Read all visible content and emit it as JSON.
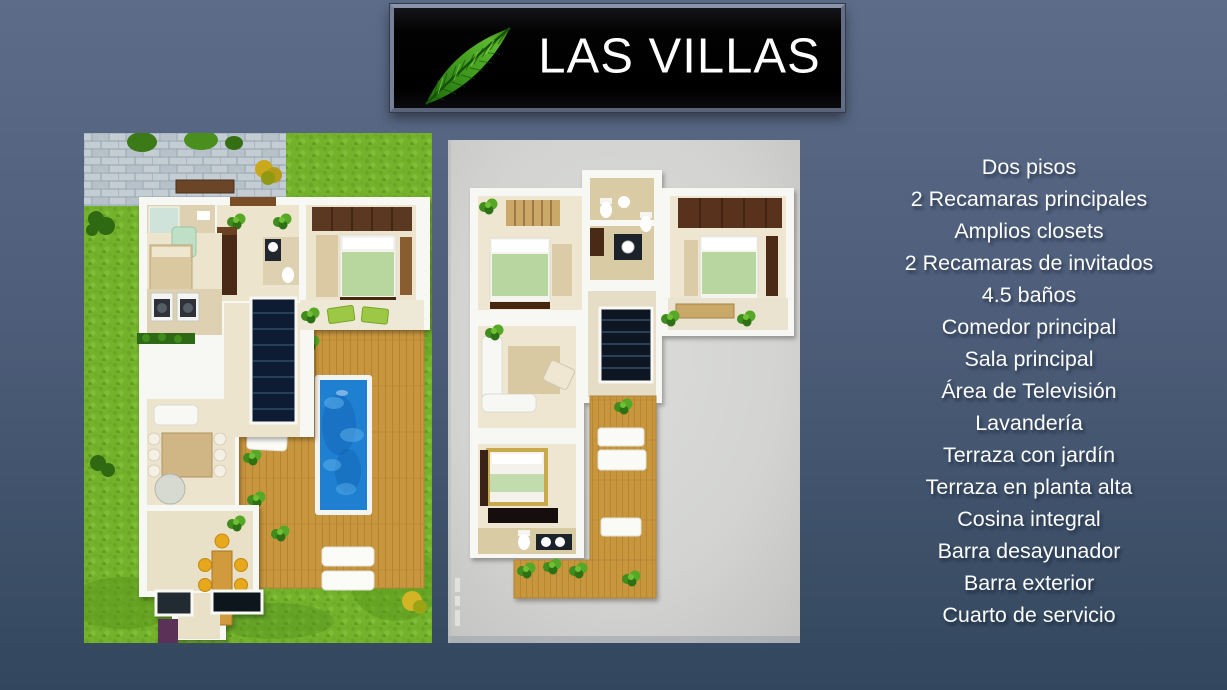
{
  "slide": {
    "title_banner": {
      "title": "LAS VILLAS",
      "icon": "palm-leaf"
    },
    "figures": {
      "left": "ground-floor-plan-render",
      "right": "upper-floor-plan-render"
    },
    "features": {
      "items": [
        "Dos pisos",
        "2 Recamaras principales",
        "Amplios closets",
        "2 Recamaras de invitados",
        "4.5 baños",
        "Comedor principal",
        "Sala principal",
        "Área de Televisión",
        "Lavandería",
        "Terraza con jardín",
        "Terraza en planta alta",
        "Cosina integral",
        "Barra desayunador",
        "Barra exterior",
        "Cuarto de servicio"
      ]
    },
    "colors": {
      "background_top": "#5d6c89",
      "background_bottom": "#32475d",
      "banner_bg": "#060606",
      "banner_frame": "#717b90",
      "title_text": "#ffffff",
      "feature_text": "#fbfcfe",
      "leaf_green": "#3f9a1d",
      "grass_green": "#74b22c",
      "pool_blue": "#1f80d2",
      "deck_wood": "#c8963e",
      "plan_bg_gray": "#d5d6d4"
    }
  }
}
